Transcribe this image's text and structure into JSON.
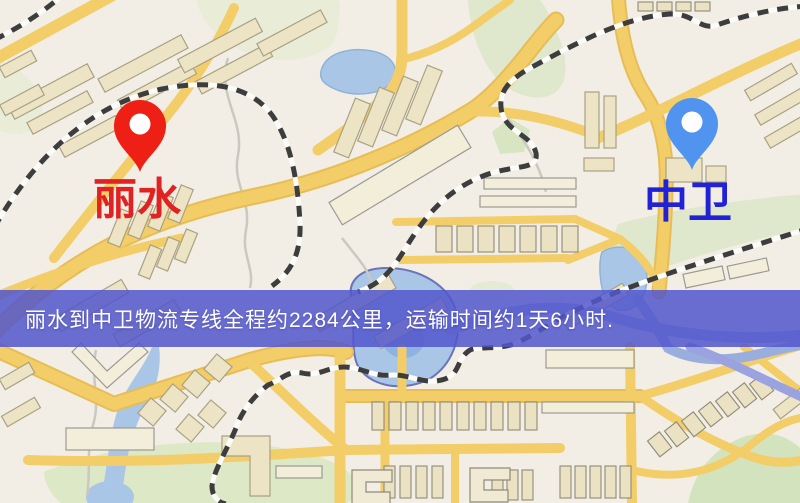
{
  "map": {
    "origin": {
      "label": "丽水",
      "pin_color": "#ee1f14",
      "label_color": "#e02222"
    },
    "destination": {
      "label": "中卫",
      "pin_color": "#5094ef",
      "label_color": "#2121d6"
    },
    "banner": {
      "text": "丽水到中卫物流专线全程约2284公里，运输时间约1天6小时.",
      "background_color": "#5256cd",
      "text_color": "#ffffff"
    }
  }
}
